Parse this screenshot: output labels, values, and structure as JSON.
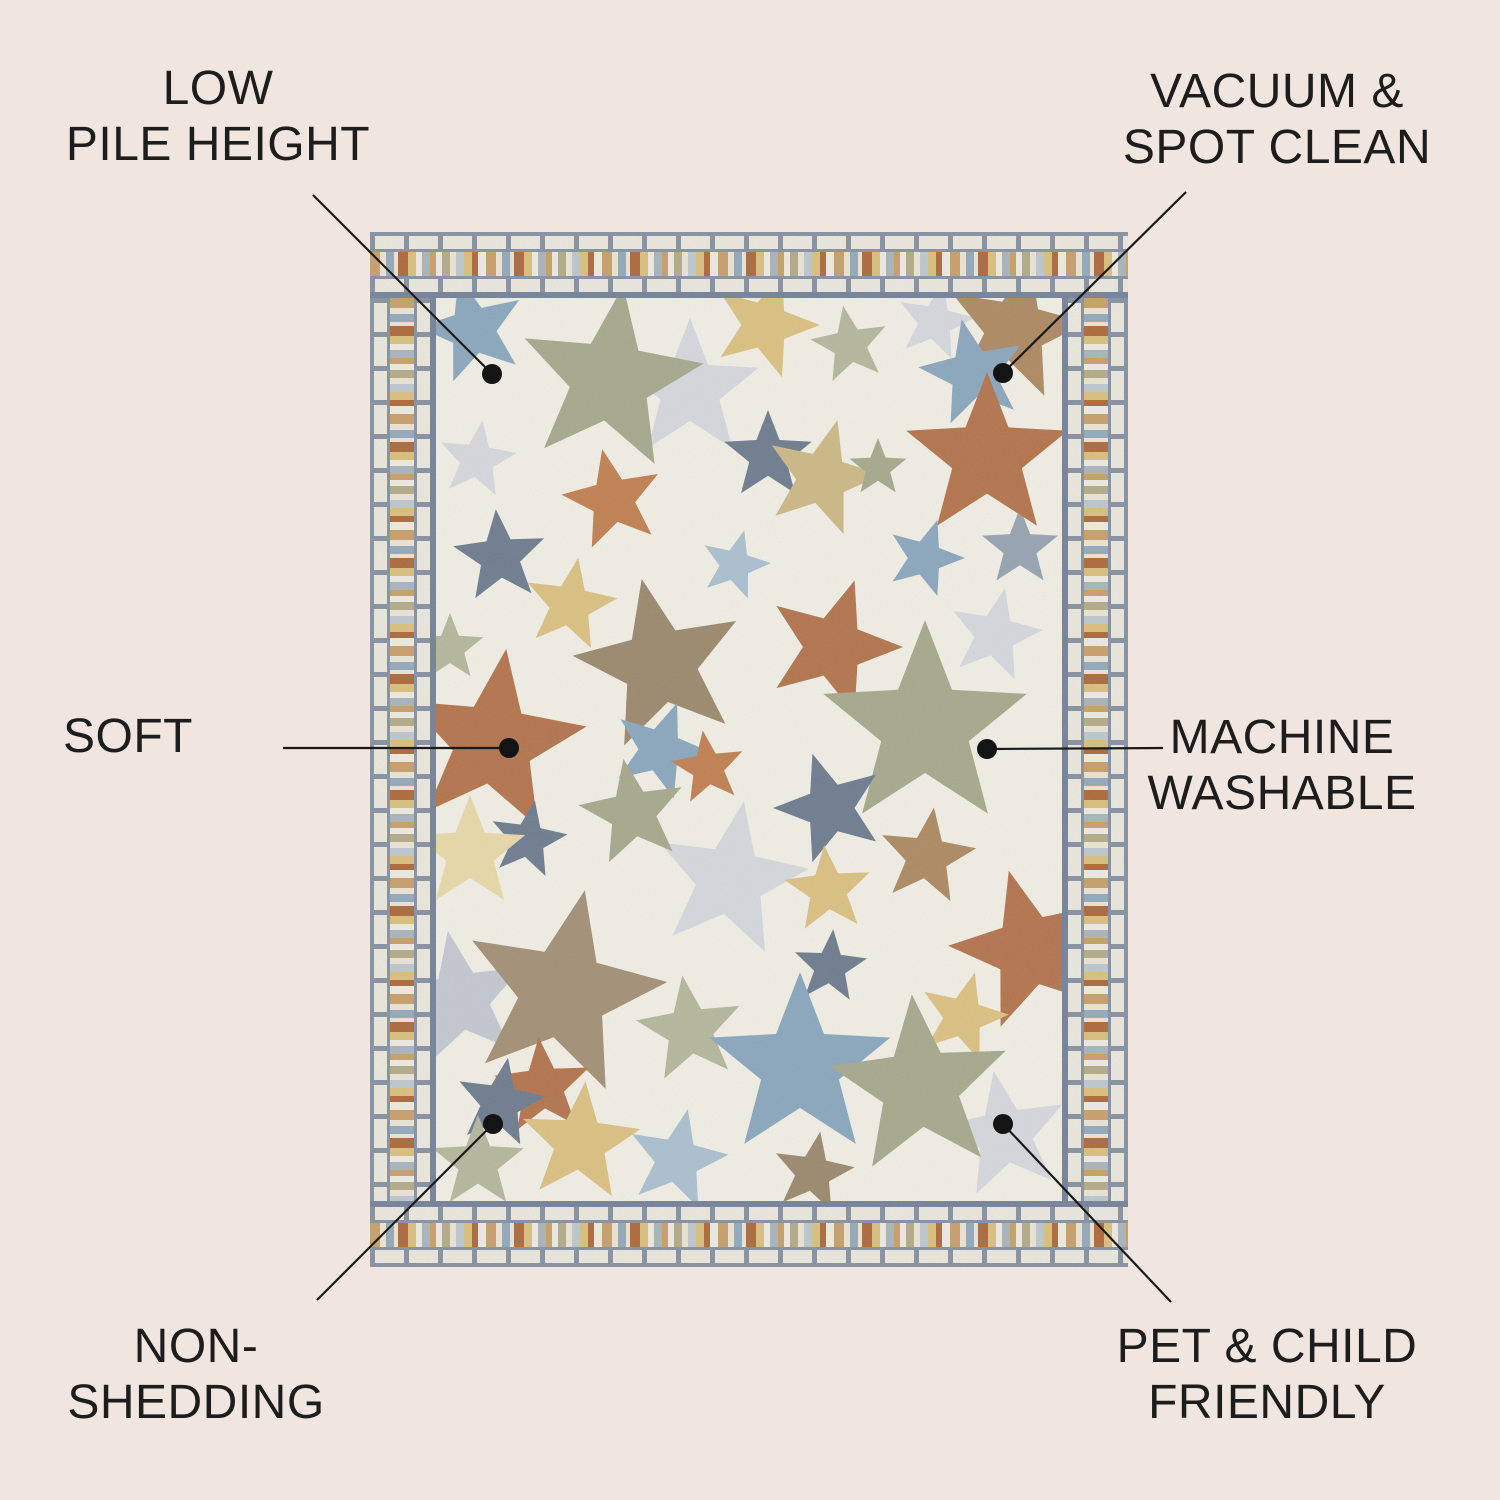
{
  "page": {
    "background": "#f0e5df"
  },
  "style": {
    "text_color": "#1d1d1d",
    "line_color": "#1a1a1a",
    "dot_radius": 10
  },
  "callouts": [
    {
      "id": "low-pile-height",
      "lines": [
        "LOW",
        "PILE HEIGHT"
      ],
      "cx": 218,
      "cy": 117,
      "line": {
        "x1": 313,
        "y1": 195,
        "x2": 492,
        "y2": 374
      },
      "dot": {
        "x": 492,
        "y": 374
      }
    },
    {
      "id": "vacuum-spot-clean",
      "lines": [
        "VACUUM &",
        "SPOT CLEAN"
      ],
      "cx": 1277,
      "cy": 120,
      "line": {
        "x1": 1186,
        "y1": 192,
        "x2": 1003,
        "y2": 373
      },
      "dot": {
        "x": 1003,
        "y": 373
      }
    },
    {
      "id": "soft",
      "lines": [
        "SOFT"
      ],
      "cx": 128,
      "cy": 737,
      "line": {
        "x1": 283,
        "y1": 748,
        "x2": 509,
        "y2": 748
      },
      "dot": {
        "x": 509,
        "y": 748
      }
    },
    {
      "id": "machine-washable",
      "lines": [
        "MACHINE",
        "WASHABLE"
      ],
      "cx": 1282,
      "cy": 766,
      "line": {
        "x1": 1163,
        "y1": 748,
        "x2": 987,
        "y2": 749
      },
      "dot": {
        "x": 987,
        "y": 749
      }
    },
    {
      "id": "non-shedding",
      "lines": [
        "NON-",
        "SHEDDING"
      ],
      "cx": 196,
      "cy": 1375,
      "line": {
        "x1": 317,
        "y1": 1300,
        "x2": 493,
        "y2": 1124
      },
      "dot": {
        "x": 493,
        "y": 1124
      }
    },
    {
      "id": "pet-child-friendly",
      "lines": [
        "PET & CHILD",
        "FRIENDLY"
      ],
      "cx": 1267,
      "cy": 1375,
      "line": {
        "x1": 1171,
        "y1": 1302,
        "x2": 1003,
        "y2": 1124
      },
      "dot": {
        "x": 1003,
        "y": 1124
      }
    }
  ],
  "rug": {
    "x": 370,
    "y": 232,
    "width": 758,
    "height": 1035,
    "border": 66,
    "colors": {
      "field": "#efece3",
      "mortar_gray": "#8792a2",
      "inner_frame_gray": "#76839a",
      "brick_white": "#e8e5dc",
      "mosaic_stripes": [
        "#c79f6b",
        "#e8e2d3",
        "#93aabb",
        "#ad6b3f",
        "#d8bf7e",
        "#ebe8df",
        "#aab3bb",
        "#b3ab89",
        "#bcc6cd"
      ],
      "stars": {
        "sage": "#a6a98c",
        "sage_light": "#b4b79c",
        "blue": "#8ba7bd",
        "blue_light": "#aabfce",
        "slate": "#6f7e90",
        "slate_light": "#97a3b1",
        "rust": "#b3764f",
        "orange": "#c08154",
        "wheat": "#d9c083",
        "pale_yellow": "#e6d7a8",
        "khaki": "#cbb887",
        "brown": "#9b8a6f",
        "taupe": "#a39178",
        "lightgray": "#d3d6db",
        "silver": "#c2c7cf",
        "tan": "#ad8a64"
      }
    },
    "stars": [
      {
        "x": 320,
        "y": 158,
        "r": 72,
        "rot": 0,
        "c": "lightgray"
      },
      {
        "x": 565,
        "y": 90,
        "r": 40,
        "rot": 12,
        "c": "lightgray"
      },
      {
        "x": 107,
        "y": 228,
        "r": 40,
        "rot": 8,
        "c": "lightgray"
      },
      {
        "x": 625,
        "y": 403,
        "r": 48,
        "rot": 12,
        "c": "lightgray"
      },
      {
        "x": 360,
        "y": 648,
        "r": 80,
        "rot": 10,
        "c": "lightgray"
      },
      {
        "x": 90,
        "y": 768,
        "r": 70,
        "rot": -10,
        "c": "silver"
      },
      {
        "x": 635,
        "y": 903,
        "r": 65,
        "rot": -10,
        "c": "lightgray"
      },
      {
        "x": 650,
        "y": 316,
        "r": 40,
        "rot": 0,
        "c": "slate_light"
      },
      {
        "x": 103,
        "y": 98,
        "r": 55,
        "rot": -15,
        "c": "blue"
      },
      {
        "x": 240,
        "y": 148,
        "r": 95,
        "rot": 8,
        "c": "sage"
      },
      {
        "x": 395,
        "y": 93,
        "r": 55,
        "rot": 18,
        "c": "wheat"
      },
      {
        "x": 480,
        "y": 113,
        "r": 40,
        "rot": -10,
        "c": "sage_light"
      },
      {
        "x": 645,
        "y": 98,
        "r": 72,
        "rot": 12,
        "c": "tan"
      },
      {
        "x": 733,
        "y": 78,
        "r": 48,
        "rot": 0,
        "c": "khaki"
      },
      {
        "x": 243,
        "y": 268,
        "r": 52,
        "rot": -12,
        "c": "orange"
      },
      {
        "x": 398,
        "y": 224,
        "r": 46,
        "rot": 0,
        "c": "slate"
      },
      {
        "x": 452,
        "y": 246,
        "r": 60,
        "rot": 15,
        "c": "khaki"
      },
      {
        "x": 508,
        "y": 236,
        "r": 30,
        "rot": 0,
        "c": "sage"
      },
      {
        "x": 603,
        "y": 141,
        "r": 55,
        "rot": -12,
        "c": "blue"
      },
      {
        "x": 617,
        "y": 225,
        "r": 85,
        "rot": 0,
        "c": "rust"
      },
      {
        "x": 130,
        "y": 325,
        "r": 48,
        "rot": -5,
        "c": "slate"
      },
      {
        "x": 200,
        "y": 373,
        "r": 48,
        "rot": 10,
        "c": "wheat"
      },
      {
        "x": 80,
        "y": 416,
        "r": 35,
        "rot": 0,
        "c": "sage_light"
      },
      {
        "x": 365,
        "y": 333,
        "r": 36,
        "rot": 15,
        "c": "blue_light"
      },
      {
        "x": 555,
        "y": 326,
        "r": 40,
        "rot": 18,
        "c": "blue"
      },
      {
        "x": 290,
        "y": 433,
        "r": 88,
        "rot": -12,
        "c": "brown"
      },
      {
        "x": 463,
        "y": 415,
        "r": 70,
        "rot": 18,
        "c": "rust"
      },
      {
        "x": 123,
        "y": 511,
        "r": 95,
        "rot": 8,
        "c": "rust"
      },
      {
        "x": 290,
        "y": 518,
        "r": 50,
        "rot": 20,
        "c": "blue"
      },
      {
        "x": 338,
        "y": 536,
        "r": 38,
        "rot": -8,
        "c": "orange"
      },
      {
        "x": 263,
        "y": 581,
        "r": 55,
        "rot": -10,
        "c": "sage"
      },
      {
        "x": 158,
        "y": 608,
        "r": 40,
        "rot": 10,
        "c": "slate"
      },
      {
        "x": 100,
        "y": 621,
        "r": 58,
        "rot": 0,
        "c": "pale_yellow"
      },
      {
        "x": 555,
        "y": 495,
        "r": 107,
        "rot": 0,
        "c": "sage"
      },
      {
        "x": 460,
        "y": 576,
        "r": 57,
        "rot": -18,
        "c": "slate"
      },
      {
        "x": 557,
        "y": 625,
        "r": 50,
        "rot": 8,
        "c": "tan"
      },
      {
        "x": 458,
        "y": 658,
        "r": 45,
        "rot": -5,
        "c": "wheat"
      },
      {
        "x": 460,
        "y": 735,
        "r": 38,
        "rot": 5,
        "c": "slate"
      },
      {
        "x": 660,
        "y": 718,
        "r": 82,
        "rot": -15,
        "c": "rust"
      },
      {
        "x": 593,
        "y": 785,
        "r": 46,
        "rot": 15,
        "c": "wheat"
      },
      {
        "x": 193,
        "y": 761,
        "r": 105,
        "rot": 12,
        "c": "taupe"
      },
      {
        "x": 320,
        "y": 798,
        "r": 55,
        "rot": -8,
        "c": "sage_light"
      },
      {
        "x": 430,
        "y": 835,
        "r": 95,
        "rot": 0,
        "c": "blue"
      },
      {
        "x": 550,
        "y": 855,
        "r": 93,
        "rot": -5,
        "c": "sage"
      },
      {
        "x": 173,
        "y": 855,
        "r": 50,
        "rot": -5,
        "c": "rust"
      },
      {
        "x": 130,
        "y": 871,
        "r": 46,
        "rot": 10,
        "c": "slate"
      },
      {
        "x": 210,
        "y": 911,
        "r": 62,
        "rot": 5,
        "c": "wheat"
      },
      {
        "x": 108,
        "y": 931,
        "r": 48,
        "rot": 0,
        "c": "sage_light"
      },
      {
        "x": 307,
        "y": 928,
        "r": 52,
        "rot": 12,
        "c": "blue_light"
      },
      {
        "x": 443,
        "y": 941,
        "r": 42,
        "rot": 10,
        "c": "brown"
      }
    ]
  }
}
